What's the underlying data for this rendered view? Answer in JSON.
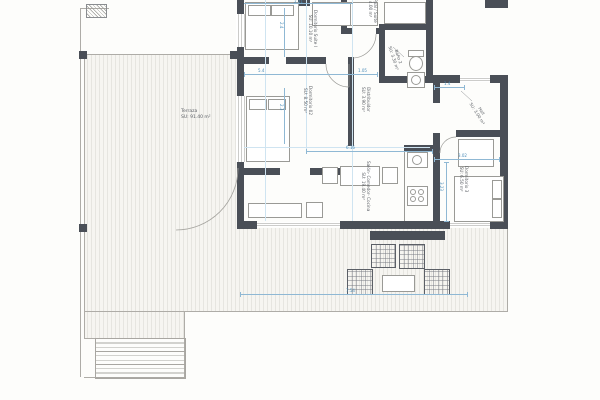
{
  "drawing": {
    "rooms": [
      {
        "name": "Dormitorio Suite I",
        "area": "SU: 10.10 m²"
      },
      {
        "name": "Baño Ppal / Suite",
        "area": "SU: 4.00 m²"
      },
      {
        "name": "Dormitorio 02",
        "area": "SU: 8.50 m²"
      },
      {
        "name": "Baño 2",
        "area": "SU: 3.30 m²"
      },
      {
        "name": "Distribuidor",
        "area": "SU: 3.90 m²"
      },
      {
        "name": "Hall",
        "area": "SU: 3.00 m²"
      },
      {
        "name": "Salón- Comedor- Cocina",
        "area": "SU: 19.40 m²"
      },
      {
        "name": "Dormitorio 3",
        "area": "SU: 6.50 m²"
      },
      {
        "name": "Terraza",
        "area": "SU: 91.40 m²"
      }
    ],
    "dimensions": {
      "top": "2.41",
      "suite_depth": "2.4",
      "dorm02_width": "5.4",
      "distribuidor_width": "1.05",
      "dorm02_depth": "2.3",
      "hall_width": "1.4",
      "salon_width": "6.16",
      "dorm3_width": "3.02",
      "dorm3_depth": "3.23",
      "terraza_width": "7.54"
    },
    "colors": {
      "wall": "#4a4f57",
      "dimension_blue": "#5f9cc5",
      "line_gray": "#a8a6a1",
      "label_gray": "#5d6167"
    }
  }
}
